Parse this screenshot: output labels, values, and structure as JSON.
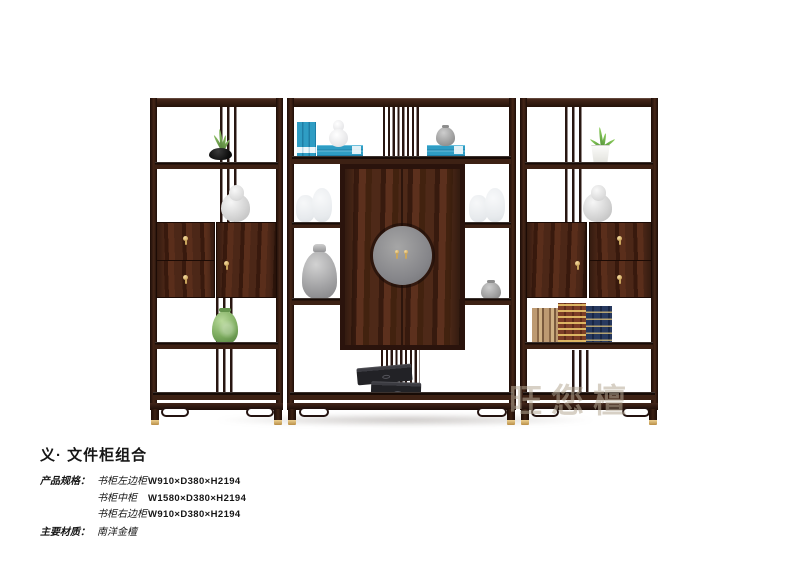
{
  "watermark": {
    "text": "旺您檀"
  },
  "info": {
    "title": "义· 文件柜组合",
    "spec_label": "产品规格：",
    "specs": [
      {
        "name": "书柜左边柜",
        "dims": "W910×D380×H2194"
      },
      {
        "name": "书柜中柜",
        "dims": "W1580×D380×H2194"
      },
      {
        "name": "书柜右边柜",
        "dims": "W910×D380×H2194"
      }
    ],
    "material_label": "主要材质：",
    "material_value": "南洋金檀"
  },
  "furniture_palette": {
    "wood_dark": "#2a1510",
    "wood_mid": "#46281c",
    "brass": "#d8b269",
    "book_blue": "#2f9dc4",
    "plate_gray": "#8a8a8c",
    "vase_green": "#7cab5e",
    "statue_gray": "#d3d3d3"
  }
}
